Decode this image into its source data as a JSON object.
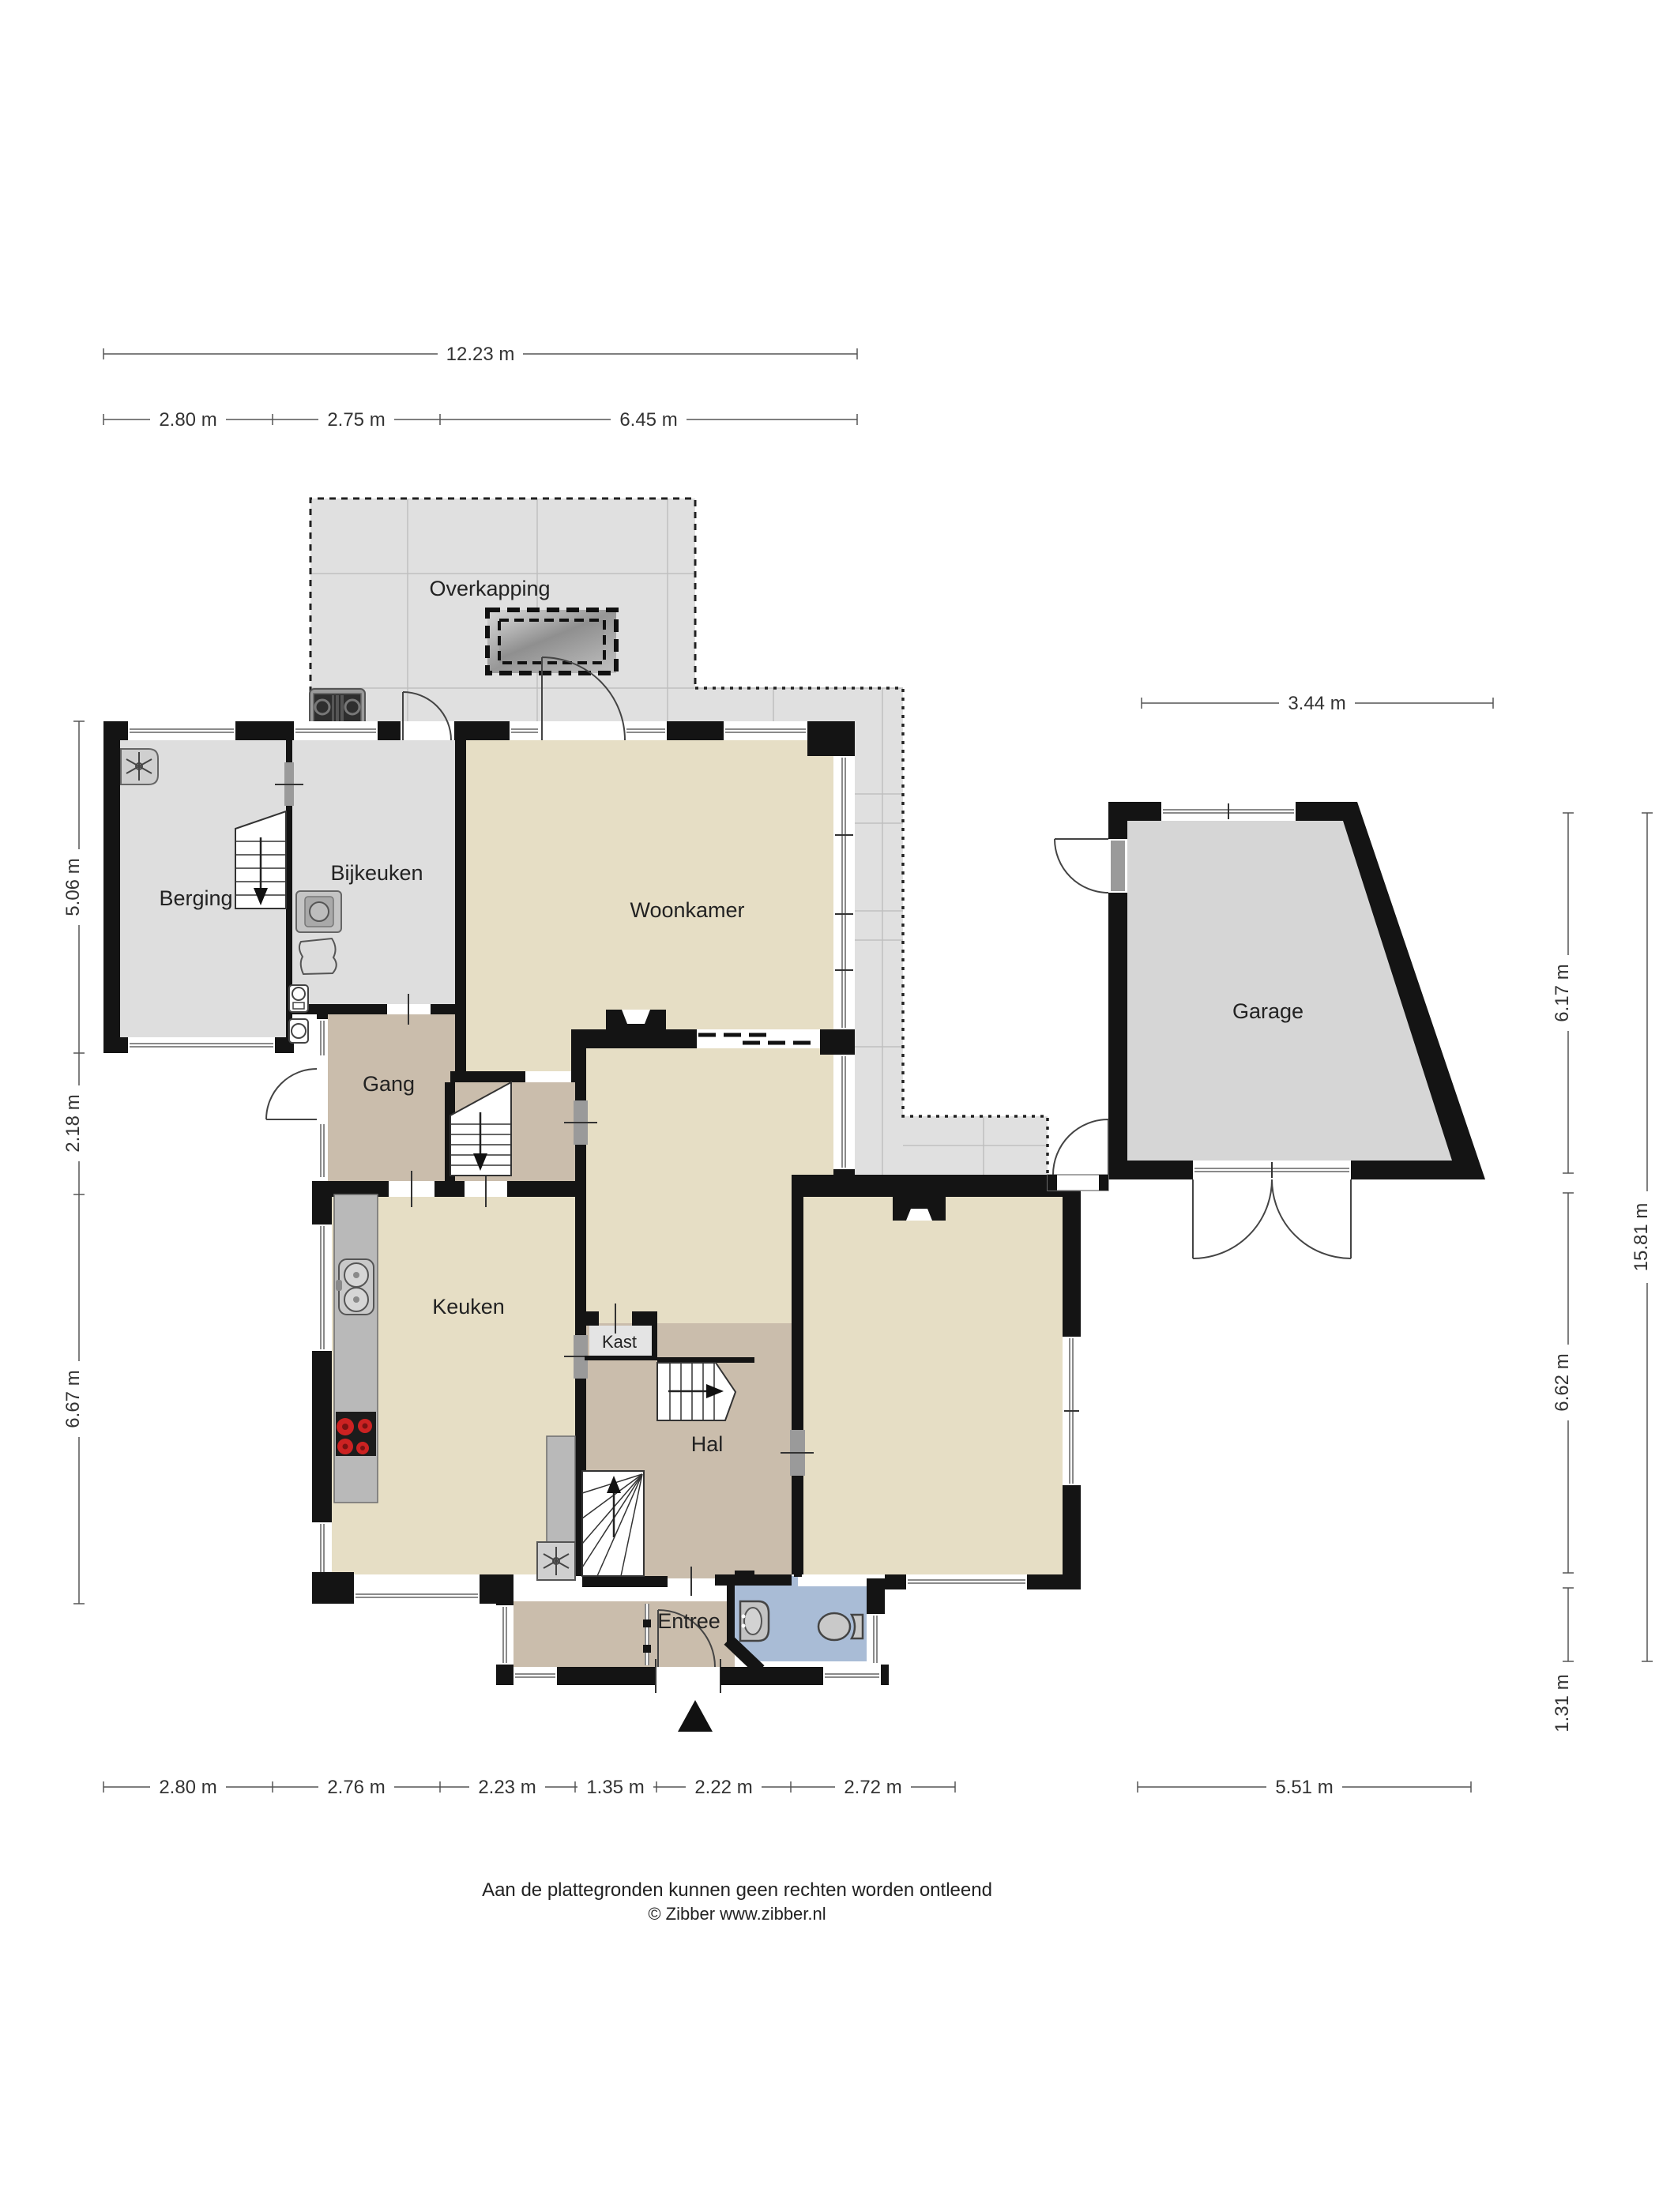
{
  "title": "Floor plan ground floor",
  "rooms": [
    {
      "id": "overkapping",
      "label": "Overkapping"
    },
    {
      "id": "berging",
      "label": "Berging"
    },
    {
      "id": "bijkeuken",
      "label": "Bijkeuken"
    },
    {
      "id": "woonkamer",
      "label": "Woonkamer"
    },
    {
      "id": "gang",
      "label": "Gang"
    },
    {
      "id": "keuken",
      "label": "Keuken"
    },
    {
      "id": "kast",
      "label": "Kast"
    },
    {
      "id": "hal",
      "label": "Hal"
    },
    {
      "id": "entree",
      "label": "Entree"
    },
    {
      "id": "garage",
      "label": "Garage"
    }
  ],
  "dimensions": {
    "top_total": [
      {
        "label": "12.23 m"
      }
    ],
    "top_segments": [
      {
        "label": "2.80 m"
      },
      {
        "label": "2.75 m"
      },
      {
        "label": "6.45 m"
      }
    ],
    "left": [
      {
        "label": "5.06 m"
      },
      {
        "label": "2.18 m"
      },
      {
        "label": "6.67 m"
      }
    ],
    "right_inner": [
      {
        "label": "6.17 m"
      },
      {
        "label": "6.62 m"
      },
      {
        "label": "1.31 m"
      }
    ],
    "right_outer": [
      {
        "label": "15.81 m"
      }
    ],
    "garage_top": [
      {
        "label": "3.44 m"
      }
    ],
    "bottom": [
      {
        "label": "2.80 m"
      },
      {
        "label": "2.76 m"
      },
      {
        "label": "2.23 m"
      },
      {
        "label": "1.35 m"
      },
      {
        "label": "2.22 m"
      },
      {
        "label": "2.72 m"
      },
      {
        "label": "5.51 m"
      }
    ]
  },
  "footer": {
    "line1": "Aan de plattegronden kunnen geen rechten worden ontleend",
    "line2": "© Zibber www.zibber.nl"
  },
  "icons": [
    "ventilation-fan-icon",
    "washing-machine-icon",
    "laundry-basket-icon",
    "outdoor-cooktop-icon",
    "skylight-icon",
    "sink-icon",
    "cooktop-icon",
    "toilet-icon",
    "washbasin-icon",
    "stairs-icon",
    "entrance-arrow-icon",
    "meter-cabinet-icon"
  ],
  "colors": {
    "wall": "#141414",
    "floor_gray": "#dedede",
    "floor_beige": "#e6dec5",
    "floor_tan": "#cabdac",
    "floor_blue": "#a9bcd6",
    "counter": "#b9b9b9",
    "burner_red": "#cc2222"
  }
}
